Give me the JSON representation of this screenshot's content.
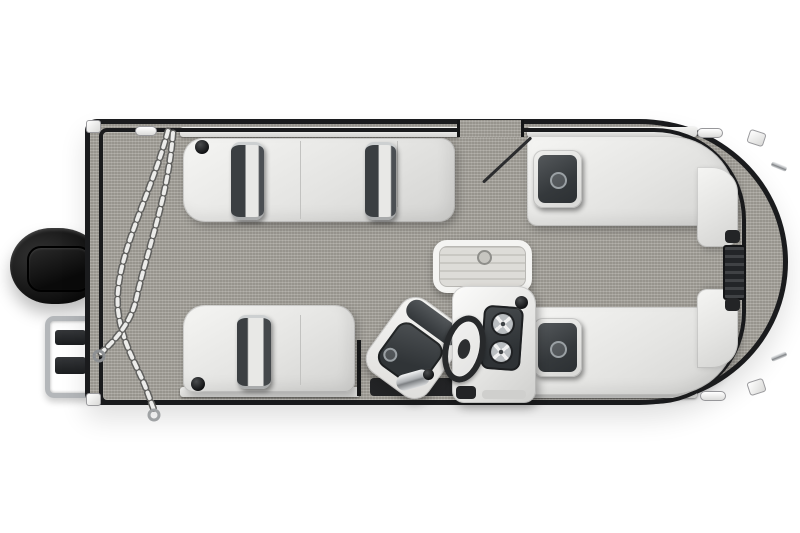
{
  "scene": {
    "title": "Overhead floor-plan rendering of a pontoon boat",
    "background_color": "#ffffff"
  },
  "palette": {
    "carpet_gray": "#a3a099",
    "rail_black": "#1a1b1d",
    "upholstery_white": "#eaeae8",
    "cushion_charcoal": "#3b3f42",
    "chrome_silver": "#c7c9cb",
    "motor_black": "#0d0d0d",
    "table_surface": "#d8d7d3"
  },
  "parts": {
    "hull": "Pontoon hull with black perimeter rail and gray woven flooring",
    "outboard_motor": "Black outboard motor on stern bracket",
    "stern_deck": "Stern deck with draped anchor chain",
    "boarding_ladder": "Folded chrome boarding ladder with black steps",
    "port_stern_lounge": "Port-side stern bench with two rolled headrest pillows and cupholder",
    "starboard_stern_lounge": "Starboard-side stern bench with rolled headrest pillow and cupholder",
    "port_bow_lounge": "Port bow wraparound lounge with logo headrest",
    "starboard_bow_lounge": "Starboard bow wraparound lounge with logo headrest",
    "helm_console": "White helm console with dark twin-gauge panel",
    "steering_wheel": "Steering wheel seen edge-on",
    "throttle": "Chrome throttle lever",
    "captain_chair": "Rotated captain's chair with charcoal cushions",
    "cocktail_table": "Center cocktail table with slatted top and latch",
    "bow_gate": "Bow boarding gate with hinges",
    "side_gate": "Port side entry gate with open door",
    "cleats": "White mooring cleats and corner caps"
  }
}
